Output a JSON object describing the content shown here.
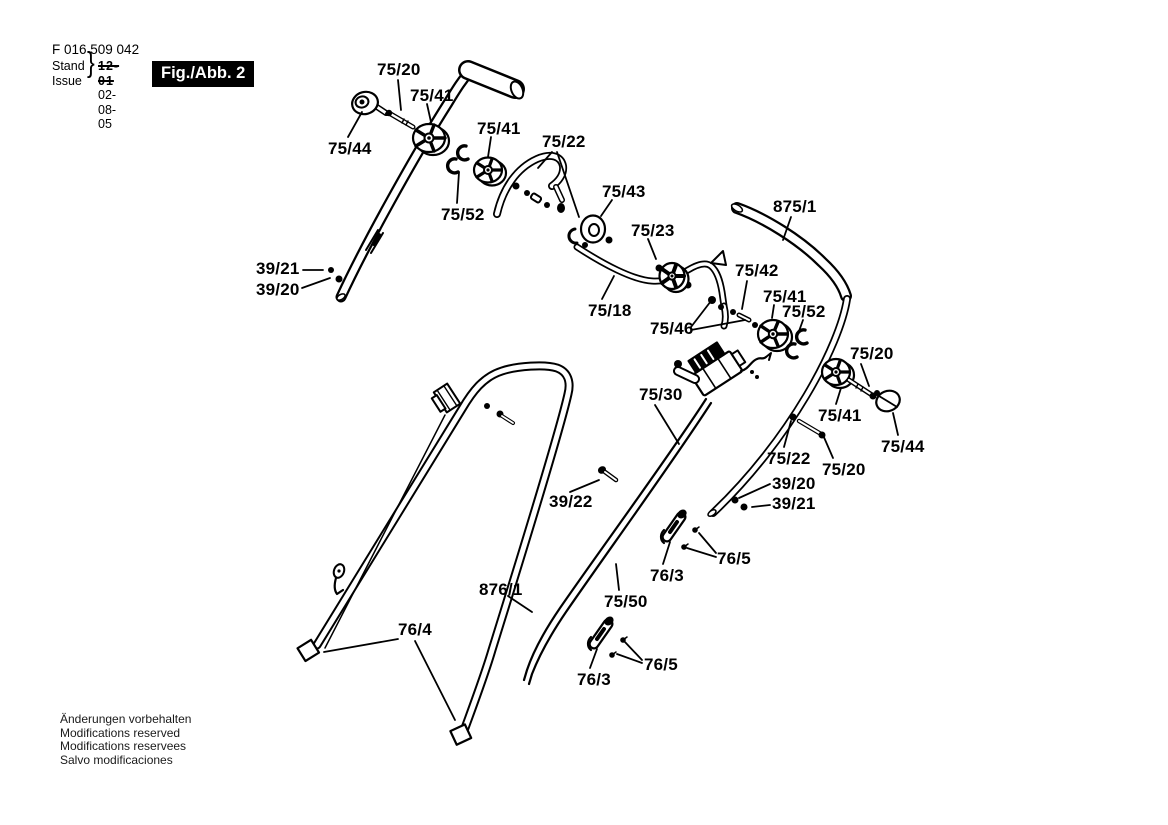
{
  "colors": {
    "paper": "#ffffff",
    "ink": "#000000",
    "badge_bg": "#000000",
    "badge_fg": "#ffffff"
  },
  "header": {
    "part_number": "F 016 509 042",
    "stand_label": "Stand",
    "issue_label": "Issue",
    "old_date": "12-01",
    "date": "02-08-05",
    "figure_label": "Fig./Abb. 2"
  },
  "footer": {
    "notes": [
      "Änderungen vorbehalten",
      "Modifications reserved",
      "Modifications reservees",
      "Salvo modificaciones"
    ]
  },
  "diagram": {
    "description": "Exploded parts diagram of lawn-mower handle assembly",
    "labels": [
      {
        "text": "75/20",
        "x": 377,
        "y": 60,
        "leaders": [
          [
            398,
            80,
            401,
            110
          ]
        ]
      },
      {
        "text": "75/41",
        "x": 410,
        "y": 86,
        "leaders": [
          [
            427,
            104,
            431,
            122
          ]
        ]
      },
      {
        "text": "75/44",
        "x": 328,
        "y": 139,
        "leaders": [
          [
            348,
            137,
            362,
            112
          ]
        ]
      },
      {
        "text": "75/41",
        "x": 477,
        "y": 119,
        "leaders": [
          [
            491,
            137,
            488,
            157
          ]
        ]
      },
      {
        "text": "75/22",
        "x": 542,
        "y": 132,
        "leaders": [
          [
            552,
            152,
            538,
            168
          ],
          [
            557,
            152,
            579,
            217
          ]
        ]
      },
      {
        "text": "75/52",
        "x": 441,
        "y": 205,
        "leaders": [
          [
            457,
            203,
            459,
            172
          ]
        ]
      },
      {
        "text": "75/43",
        "x": 602,
        "y": 182,
        "leaders": [
          [
            612,
            200,
            601,
            216
          ]
        ]
      },
      {
        "text": "75/23",
        "x": 631,
        "y": 221,
        "leaders": [
          [
            648,
            239,
            656,
            259
          ]
        ]
      },
      {
        "text": "875/1",
        "x": 773,
        "y": 197,
        "leaders": [
          [
            791,
            217,
            783,
            240
          ]
        ]
      },
      {
        "text": "39/21",
        "x": 256,
        "y": 259,
        "leaders": [
          [
            303,
            270,
            323,
            270
          ]
        ]
      },
      {
        "text": "39/20",
        "x": 256,
        "y": 280,
        "leaders": [
          [
            302,
            288,
            330,
            278
          ]
        ]
      },
      {
        "text": "75/18",
        "x": 588,
        "y": 301,
        "leaders": [
          [
            602,
            299,
            614,
            276
          ]
        ]
      },
      {
        "text": "75/42",
        "x": 735,
        "y": 261,
        "leaders": [
          [
            747,
            281,
            742,
            309
          ]
        ]
      },
      {
        "text": "75/41",
        "x": 763,
        "y": 287,
        "leaders": [
          [
            774,
            305,
            772,
            318
          ]
        ]
      },
      {
        "text": "75/52",
        "x": 782,
        "y": 302,
        "leaders": [
          [
            803,
            320,
            798,
            334
          ]
        ]
      },
      {
        "text": "75/46",
        "x": 650,
        "y": 319,
        "leaders": [
          [
            691,
            327,
            711,
            301
          ],
          [
            691,
            330,
            745,
            320
          ]
        ]
      },
      {
        "text": "75/20",
        "x": 850,
        "y": 344,
        "leaders": [
          [
            861,
            364,
            869,
            386
          ]
        ]
      },
      {
        "text": "75/30",
        "x": 639,
        "y": 385,
        "leaders": [
          [
            655,
            405,
            679,
            444
          ]
        ]
      },
      {
        "text": "75/41",
        "x": 818,
        "y": 406,
        "leaders": [
          [
            836,
            404,
            841,
            388
          ]
        ]
      },
      {
        "text": "75/44",
        "x": 881,
        "y": 437,
        "leaders": [
          [
            898,
            435,
            893,
            413
          ]
        ]
      },
      {
        "text": "75/22",
        "x": 767,
        "y": 449,
        "leaders": [
          [
            784,
            447,
            791,
            421
          ]
        ]
      },
      {
        "text": "75/20",
        "x": 822,
        "y": 460,
        "leaders": [
          [
            833,
            458,
            823,
            435
          ]
        ]
      },
      {
        "text": "39/20",
        "x": 772,
        "y": 474,
        "leaders": [
          [
            770,
            484,
            739,
            498
          ]
        ]
      },
      {
        "text": "39/21",
        "x": 772,
        "y": 494,
        "leaders": [
          [
            770,
            505,
            752,
            507
          ]
        ]
      },
      {
        "text": "39/22",
        "x": 549,
        "y": 492,
        "leaders": [
          [
            570,
            492,
            599,
            480
          ]
        ]
      },
      {
        "text": "76/5",
        "x": 717,
        "y": 549,
        "leaders": [
          [
            716,
            553,
            699,
            533
          ],
          [
            716,
            557,
            687,
            548
          ]
        ]
      },
      {
        "text": "76/3",
        "x": 650,
        "y": 566,
        "leaders": [
          [
            663,
            564,
            670,
            542
          ]
        ]
      },
      {
        "text": "876/1",
        "x": 479,
        "y": 580,
        "leaders": [
          [
            508,
            596,
            532,
            612
          ]
        ]
      },
      {
        "text": "75/50",
        "x": 604,
        "y": 592,
        "leaders": [
          [
            619,
            590,
            616,
            564
          ]
        ]
      },
      {
        "text": "76/4",
        "x": 398,
        "y": 620,
        "leaders": [
          [
            398,
            639,
            324,
            652
          ],
          [
            415,
            641,
            455,
            720
          ]
        ]
      },
      {
        "text": "76/5",
        "x": 644,
        "y": 655,
        "leaders": [
          [
            642,
            660,
            624,
            641
          ],
          [
            642,
            663,
            617,
            654
          ]
        ]
      },
      {
        "text": "76/3",
        "x": 577,
        "y": 670,
        "leaders": [
          [
            590,
            668,
            597,
            649
          ]
        ]
      }
    ]
  }
}
